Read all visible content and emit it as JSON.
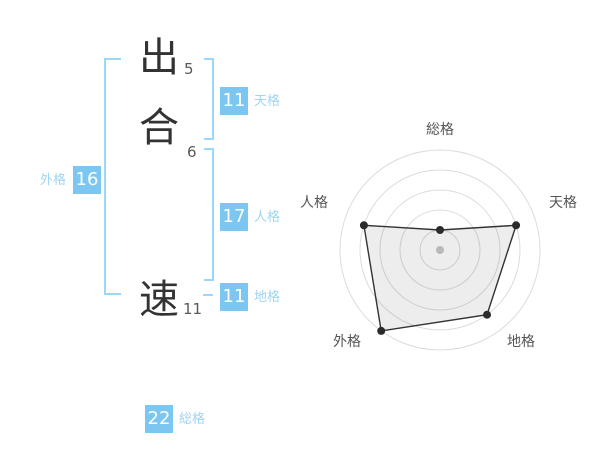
{
  "name": {
    "chars": [
      {
        "char": "出",
        "strokes": "5"
      },
      {
        "char": "合",
        "strokes": "6"
      },
      {
        "char": "速",
        "strokes": "11"
      }
    ]
  },
  "kaku": {
    "tenkaku": {
      "label": "天格",
      "value": "11"
    },
    "jinkaku": {
      "label": "人格",
      "value": "17"
    },
    "chikaku": {
      "label": "地格",
      "value": "11"
    },
    "gaikaku": {
      "label": "外格",
      "value": "16"
    },
    "soukaku": {
      "label": "総格",
      "value": "22"
    }
  },
  "colors": {
    "accent_blue": "#7cc7f1",
    "label_blue": "#9fd4f3",
    "bracket_blue": "#9bd7f7",
    "ring_gray": "#dcdcdc",
    "polygon_line": "#333333",
    "polygon_fill": "rgba(0,0,0,0.07)",
    "point_dark": "#2b2b2b",
    "center_dot": "#c8c8c8",
    "axis_label": "#555555"
  },
  "chart_data": {
    "type": "radar",
    "categories": [
      "総格",
      "天格",
      "地格",
      "外格",
      "人格"
    ],
    "values": [
      1,
      4,
      4,
      5,
      4
    ],
    "max": 5,
    "rings": 5,
    "start_angle_deg": -90,
    "direction": "clockwise",
    "grid": "concentric-circles",
    "legend": "none",
    "title": ""
  }
}
